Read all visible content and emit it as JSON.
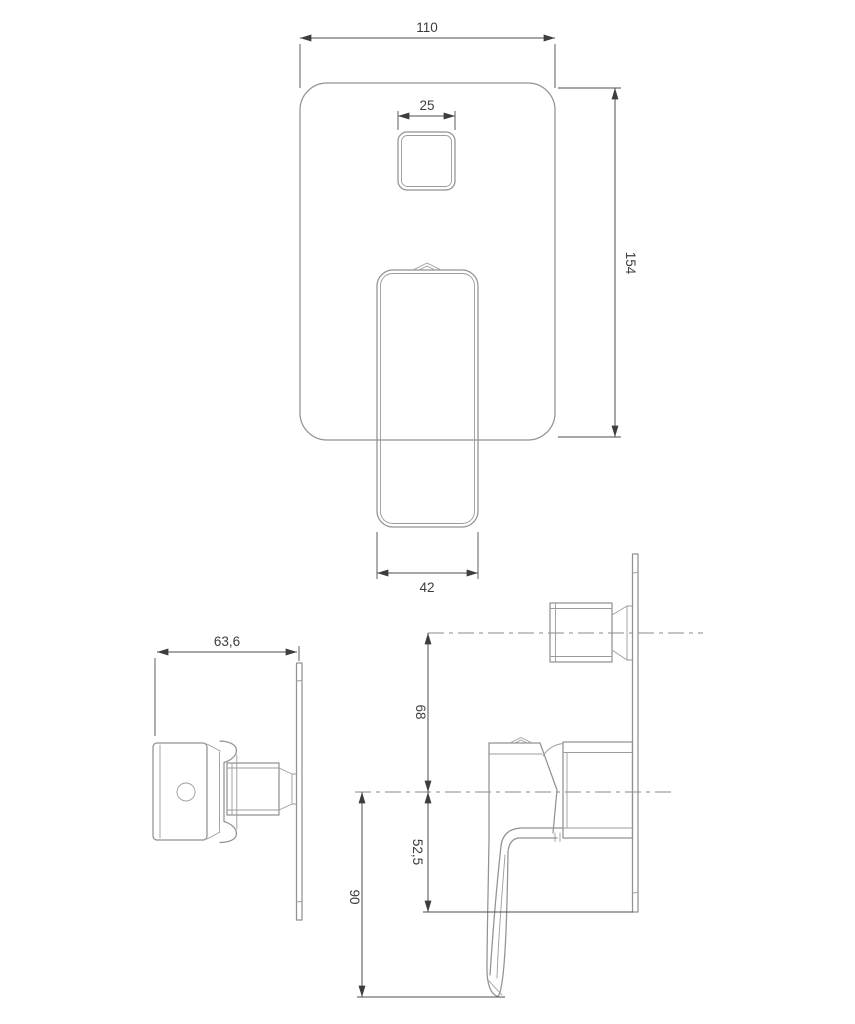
{
  "drawing_title": "concealed-shower-mixer-dimensional-drawing",
  "colors": {
    "background": "#ffffff",
    "geometry_line": "#929292",
    "dimension_line": "#4d4d4d",
    "text": "#3d3d3d"
  },
  "dims": {
    "plate_width": "110",
    "button_width": "25",
    "plate_height": "154",
    "handle_width": "42",
    "total_depth": "63,6",
    "button_axis_offset": "68",
    "plate_below_axis": "52,5",
    "handle_drop_below_axis": "90"
  }
}
